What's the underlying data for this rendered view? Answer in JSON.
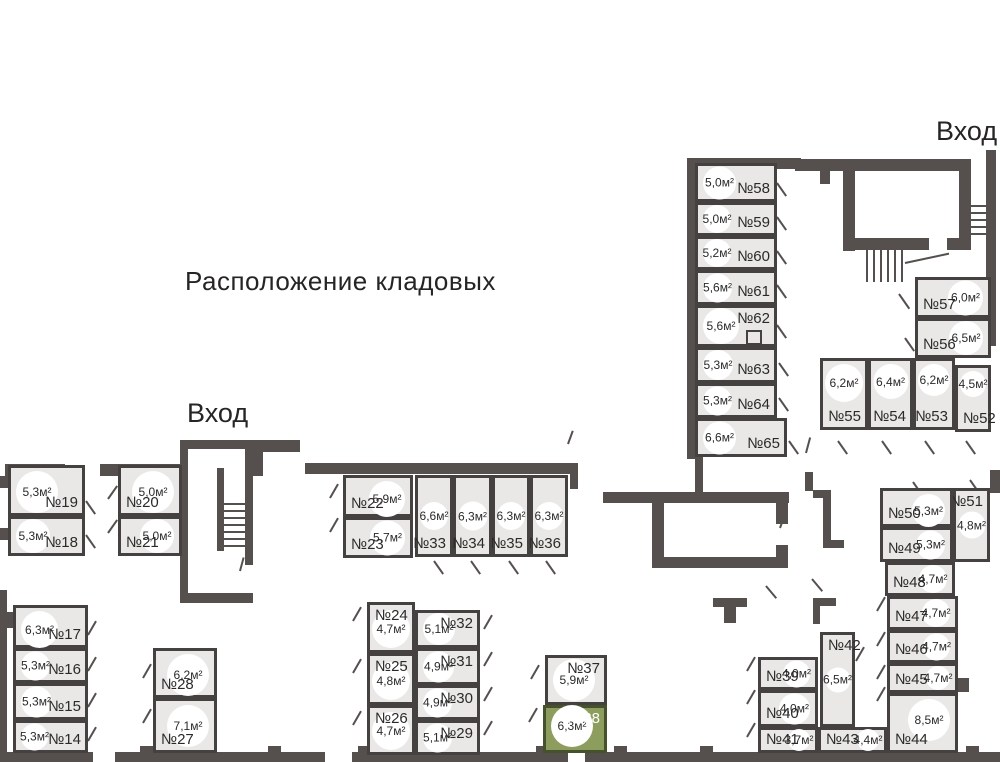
{
  "title": "Расположение кладовых",
  "entrance_top": "Вход",
  "entrance_left": "Вход",
  "colors": {
    "wall": "#55504d",
    "room_fill": "#e9e8e7",
    "room_border": "#454140",
    "selected_fill": "#8c9d5e",
    "selected_border": "#46522b",
    "text": "#2b2a29"
  },
  "selected_unit": {
    "num": "№38",
    "area": "6,3м²"
  },
  "rooms": [
    {
      "num": "№58",
      "area": "5,0м²",
      "x": 695,
      "y": 163,
      "w": 82,
      "h": 39,
      "cpos": "l",
      "npos": "br"
    },
    {
      "num": "№59",
      "area": "5,0м²",
      "x": 695,
      "y": 202,
      "w": 82,
      "h": 34,
      "cpos": "l",
      "npos": "br"
    },
    {
      "num": "№60",
      "area": "5,2м²",
      "x": 695,
      "y": 236,
      "w": 82,
      "h": 34,
      "cpos": "l",
      "npos": "br"
    },
    {
      "num": "№61",
      "area": "5,6м²",
      "x": 695,
      "y": 270,
      "w": 82,
      "h": 35,
      "cpos": "l",
      "npos": "br"
    },
    {
      "num": "№62",
      "area": "5,6м²",
      "x": 695,
      "y": 305,
      "w": 82,
      "h": 42,
      "cpos": "l",
      "npos": "tr"
    },
    {
      "num": "№63",
      "area": "5,3м²",
      "x": 695,
      "y": 347,
      "w": 82,
      "h": 36,
      "cpos": "l",
      "npos": "br"
    },
    {
      "num": "№64",
      "area": "5,3м²",
      "x": 695,
      "y": 383,
      "w": 82,
      "h": 35,
      "cpos": "l",
      "npos": "br"
    },
    {
      "num": "№65",
      "area": "6,6м²",
      "x": 695,
      "y": 418,
      "w": 92,
      "h": 39,
      "cpos": "l",
      "npos": "br"
    },
    {
      "num": "№57",
      "area": "6,0м²",
      "x": 915,
      "y": 277,
      "w": 76,
      "h": 41,
      "cpos": "r",
      "npos": "bl"
    },
    {
      "num": "№56",
      "area": "6,5м²",
      "x": 915,
      "y": 318,
      "w": 76,
      "h": 40,
      "cpos": "r",
      "npos": "bl"
    },
    {
      "num": "№55",
      "area": "6,2м²",
      "x": 820,
      "y": 358,
      "w": 48,
      "h": 72,
      "cpos": "t",
      "npos": "br"
    },
    {
      "num": "№54",
      "area": "6,4м²",
      "x": 868,
      "y": 358,
      "w": 45,
      "h": 72,
      "cpos": "t",
      "npos": "br"
    },
    {
      "num": "№53",
      "area": "6,2м²",
      "x": 913,
      "y": 358,
      "w": 42,
      "h": 72,
      "cpos": "t",
      "npos": "br"
    },
    {
      "num": "№52",
      "area": "4,5м²",
      "x": 955,
      "y": 365,
      "w": 36,
      "h": 67,
      "cpos": "t",
      "npos": "bl"
    },
    {
      "num": "№51",
      "area": "4,8м²",
      "x": 953,
      "y": 488,
      "w": 37,
      "h": 74,
      "cpos": "c",
      "npos": "tr"
    },
    {
      "num": "№50",
      "area": "5,3м²",
      "x": 880,
      "y": 488,
      "w": 73,
      "h": 39,
      "cpos": "tr",
      "npos": "bl"
    },
    {
      "num": "№49",
      "area": "5,3м²",
      "x": 880,
      "y": 527,
      "w": 73,
      "h": 35,
      "cpos": "r",
      "npos": "bl"
    },
    {
      "num": "№48",
      "area": "4,7м²",
      "x": 885,
      "y": 562,
      "w": 70,
      "h": 34,
      "cpos": "r",
      "npos": "bl"
    },
    {
      "num": "№47",
      "area": "4,7м²",
      "x": 887,
      "y": 596,
      "w": 71,
      "h": 34,
      "cpos": "r",
      "npos": "bl"
    },
    {
      "num": "№46",
      "area": "4,7м²",
      "x": 887,
      "y": 630,
      "w": 71,
      "h": 33,
      "cpos": "r",
      "npos": "bl"
    },
    {
      "num": "№45",
      "area": "4,7м²",
      "x": 887,
      "y": 663,
      "w": 71,
      "h": 30,
      "cpos": "r",
      "npos": "bl"
    },
    {
      "num": "№44",
      "area": "8,5м²",
      "x": 887,
      "y": 693,
      "w": 71,
      "h": 60,
      "cpos": "tr",
      "npos": "bl"
    },
    {
      "num": "№43",
      "area": "4,4м²",
      "x": 818,
      "y": 727,
      "w": 69,
      "h": 26,
      "cpos": "r",
      "npos": "bl"
    },
    {
      "num": "№42",
      "area": "6,5м²",
      "x": 820,
      "y": 632,
      "w": 35,
      "h": 95,
      "cpos": "c",
      "npos": "tl"
    },
    {
      "num": "№41",
      "area": "3,7м²",
      "x": 758,
      "y": 727,
      "w": 60,
      "h": 26,
      "cpos": "r",
      "npos": "bl"
    },
    {
      "num": "№40",
      "area": "4,0м²",
      "x": 758,
      "y": 690,
      "w": 60,
      "h": 37,
      "cpos": "r",
      "npos": "bl"
    },
    {
      "num": "№39",
      "area": "4,0м²",
      "x": 758,
      "y": 657,
      "w": 60,
      "h": 33,
      "cpos": "r",
      "npos": "bl"
    },
    {
      "num": "№38",
      "area": "6,3м²",
      "x": 543,
      "y": 705,
      "w": 64,
      "h": 48,
      "cpos": "bl",
      "npos": "tr",
      "selected": true
    },
    {
      "num": "№37",
      "area": "5,9м²",
      "x": 545,
      "y": 655,
      "w": 62,
      "h": 50,
      "cpos": "l",
      "npos": "tr"
    },
    {
      "num": "№36",
      "area": "6,3м²",
      "x": 530,
      "y": 475,
      "w": 38,
      "h": 82,
      "cpos": "c",
      "npos": "br"
    },
    {
      "num": "№35",
      "area": "6,3м²",
      "x": 492,
      "y": 475,
      "w": 38,
      "h": 82,
      "cpos": "c",
      "npos": "br"
    },
    {
      "num": "№34",
      "area": "6,3м²",
      "x": 453,
      "y": 475,
      "w": 39,
      "h": 82,
      "cpos": "c",
      "npos": "br"
    },
    {
      "num": "№33",
      "area": "6,6м²",
      "x": 415,
      "y": 475,
      "w": 38,
      "h": 82,
      "cpos": "c",
      "npos": "br"
    },
    {
      "num": "№32",
      "area": "5,1м²",
      "x": 415,
      "y": 610,
      "w": 65,
      "h": 38,
      "cpos": "l",
      "npos": "tr"
    },
    {
      "num": "№31",
      "area": "4,9м²",
      "x": 415,
      "y": 648,
      "w": 65,
      "h": 37,
      "cpos": "l",
      "npos": "tr"
    },
    {
      "num": "№30",
      "area": "4,9м²",
      "x": 415,
      "y": 685,
      "w": 65,
      "h": 35,
      "cpos": "l",
      "npos": "tr"
    },
    {
      "num": "№29",
      "area": "5,1м²",
      "x": 415,
      "y": 720,
      "w": 65,
      "h": 35,
      "cpos": "l",
      "npos": "tr"
    },
    {
      "num": "№28",
      "area": "6,2м²",
      "x": 153,
      "y": 648,
      "w": 64,
      "h": 50,
      "cpos": "tr",
      "npos": "bl"
    },
    {
      "num": "№27",
      "area": "7,1м²",
      "x": 153,
      "y": 698,
      "w": 64,
      "h": 55,
      "cpos": "r",
      "npos": "bl"
    },
    {
      "num": "№26",
      "area": "4,7м²",
      "x": 367,
      "y": 705,
      "w": 48,
      "h": 50,
      "cpos": "b",
      "npos": "tl"
    },
    {
      "num": "№25",
      "area": "4,8м²",
      "x": 367,
      "y": 653,
      "w": 48,
      "h": 52,
      "cpos": "b",
      "npos": "tl"
    },
    {
      "num": "№24",
      "area": "4,7м²",
      "x": 367,
      "y": 602,
      "w": 48,
      "h": 51,
      "cpos": "b",
      "npos": "tl"
    },
    {
      "num": "№23",
      "area": "5,7м²",
      "x": 343,
      "y": 517,
      "w": 70,
      "h": 41,
      "cpos": "r",
      "npos": "bl"
    },
    {
      "num": "№22",
      "area": "5,9м²",
      "x": 343,
      "y": 475,
      "w": 70,
      "h": 42,
      "cpos": "tr",
      "npos": "bl"
    },
    {
      "num": "№21",
      "area": "5,0м²",
      "x": 118,
      "y": 516,
      "w": 64,
      "h": 40,
      "cpos": "r",
      "npos": "bl"
    },
    {
      "num": "№20",
      "area": "5,0м²",
      "x": 118,
      "y": 465,
      "w": 64,
      "h": 51,
      "cpos": "tr",
      "npos": "bl"
    },
    {
      "num": "№19",
      "area": "5,3м²",
      "x": 8,
      "y": 465,
      "w": 77,
      "h": 51,
      "cpos": "tl",
      "npos": "br"
    },
    {
      "num": "№18",
      "area": "5,3м²",
      "x": 8,
      "y": 516,
      "w": 77,
      "h": 40,
      "cpos": "l",
      "npos": "br"
    },
    {
      "num": "№17",
      "area": "6,3м²",
      "x": 13,
      "y": 605,
      "w": 75,
      "h": 43,
      "cpos": "tl",
      "npos": "br"
    },
    {
      "num": "№16",
      "area": "5,3м²",
      "x": 13,
      "y": 648,
      "w": 75,
      "h": 35,
      "cpos": "l",
      "npos": "br"
    },
    {
      "num": "№15",
      "area": "5,3м²",
      "x": 13,
      "y": 683,
      "w": 75,
      "h": 37,
      "cpos": "l",
      "npos": "br"
    },
    {
      "num": "№14",
      "area": "5,3м²",
      "x": 13,
      "y": 720,
      "w": 75,
      "h": 33,
      "cpos": "l",
      "npos": "br"
    }
  ]
}
